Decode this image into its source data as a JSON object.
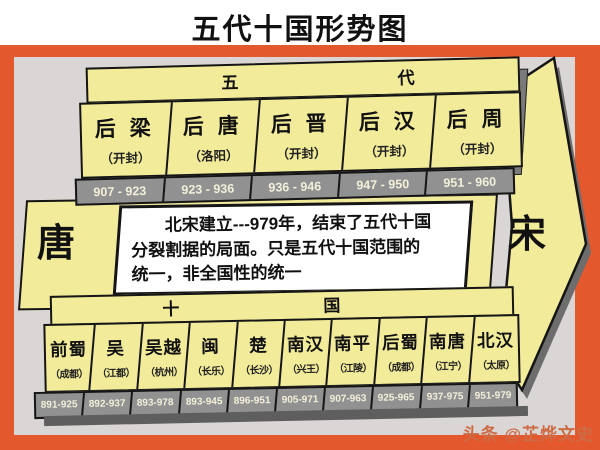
{
  "title": "五代十国形势图",
  "eras": {
    "left": "唐",
    "right": "宋"
  },
  "note": {
    "line1": "北宋建立---979年，结束了五代十国",
    "line2": "分裂割据的局面。只是五代十国范围的",
    "line3": "统一，非全国性的统一"
  },
  "five_dynasties": {
    "header": {
      "left": "五",
      "right": "代"
    },
    "items": [
      {
        "name": "后 梁",
        "capital": "（开封）",
        "years": "907 - 923"
      },
      {
        "name": "后 唐",
        "capital": "（洛阳）",
        "years": "923 - 936"
      },
      {
        "name": "后 晋",
        "capital": "（开封）",
        "years": "936 - 946"
      },
      {
        "name": "后 汉",
        "capital": "（开封）",
        "years": "947 - 950"
      },
      {
        "name": "后 周",
        "capital": "（开封）",
        "years": "951 - 960"
      }
    ]
  },
  "ten_kingdoms": {
    "header": {
      "left": "十",
      "right": "国"
    },
    "items": [
      {
        "name": "前蜀",
        "capital": "（成都）",
        "years": "891-925"
      },
      {
        "name": "吴",
        "capital": "（江都）",
        "years": "892-937"
      },
      {
        "name": "吴越",
        "capital": "（杭州）",
        "years": "893-978"
      },
      {
        "name": "闽",
        "capital": "（长乐）",
        "years": "893-945"
      },
      {
        "name": "楚",
        "capital": "（长沙）",
        "years": "896-951"
      },
      {
        "name": "南汉",
        "capital": "（兴王）",
        "years": "905-971"
      },
      {
        "name": "南平",
        "capital": "（江陵）",
        "years": "907-963"
      },
      {
        "name": "后蜀",
        "capital": "（成都）",
        "years": "925-965"
      },
      {
        "name": "南唐",
        "capital": "（江宁）",
        "years": "937-975"
      },
      {
        "name": "北汉",
        "capital": "（太原）",
        "years": "951-979"
      }
    ]
  },
  "watermark": "头条 @芷烨文史",
  "colors": {
    "frame": "#e4582e",
    "panel": "#dad6d5",
    "yellow": "#f2ec9a",
    "gray-band": "#919191",
    "shadow": "#6d6d6d",
    "ink": "#151515",
    "watermark": "#cd6b44"
  }
}
